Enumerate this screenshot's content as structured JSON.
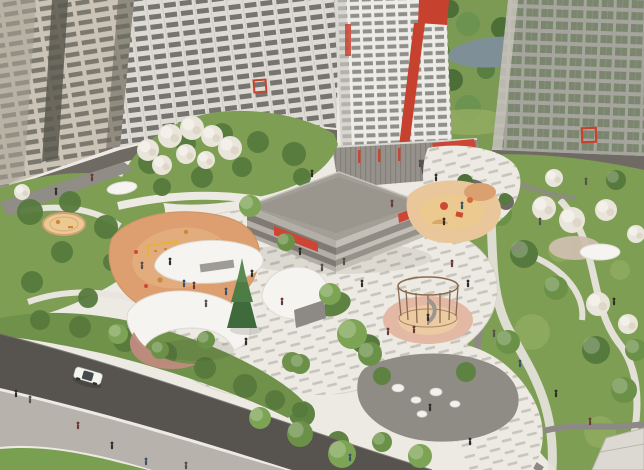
{
  "scene": {
    "kind": "Aerial architectural rendering of a residential courtyard with playgrounds, white canopy pavilions, winding paths, apartment towers and a road"
  },
  "palette": {
    "plaza": "#eceae3",
    "paver_dash": "#b0aca3",
    "lawn": "#7e9e54",
    "park_green": "#7c9a54",
    "pond": "#7e8f98",
    "road": "#57534e",
    "sidewalk": "#b7b3ac",
    "grass": "#79a050",
    "building_beige": "#cbc3b5",
    "building_white": "#dedbd4",
    "tower_white": "#edece8",
    "building_right": "#a6a59d",
    "plinth": "#6f6b64",
    "accent_red": "#c7412f",
    "awning_red": "#cd4534",
    "garage_roof": "#a39f97",
    "garage_face": "#b3afa7",
    "canopy_white": "#f5f4f0",
    "canopy_wall_pink": "#c08b80",
    "playground_orange": "#dd9f6f",
    "sand": "#ecc98e",
    "sand_pink": "#e3b8a4",
    "conifer": "#3e6a3c",
    "car_body": "#f4f4f1"
  },
  "scatter": {
    "person_colors": [
      "#2f2d2b",
      "#55504b",
      "#6b3a36",
      "#3a506b"
    ],
    "backdrop_trees": [
      [
        432,
        18,
        11
      ],
      [
        450,
        9,
        9
      ],
      [
        468,
        24,
        12
      ],
      [
        440,
        52,
        10
      ],
      [
        452,
        80,
        11
      ],
      [
        468,
        108,
        13
      ],
      [
        486,
        70,
        9
      ],
      [
        502,
        28,
        11
      ],
      [
        518,
        56,
        10
      ],
      [
        534,
        88,
        12
      ],
      [
        548,
        22,
        11
      ],
      [
        562,
        60,
        12
      ],
      [
        592,
        42,
        11
      ],
      [
        618,
        72,
        12
      ],
      [
        636,
        28,
        10
      ],
      [
        606,
        112,
        11
      ],
      [
        578,
        120,
        9
      ],
      [
        500,
        120,
        10
      ]
    ],
    "garden_bushes": [
      [
        150,
        162,
        12
      ],
      [
        186,
        144,
        10
      ],
      [
        222,
        134,
        11
      ],
      [
        258,
        142,
        11
      ],
      [
        294,
        154,
        12
      ],
      [
        242,
        167,
        10
      ],
      [
        202,
        177,
        11
      ],
      [
        162,
        187,
        9
      ],
      [
        302,
        177,
        9
      ],
      [
        30,
        212,
        13
      ],
      [
        70,
        202,
        11
      ],
      [
        106,
        227,
        12
      ],
      [
        62,
        252,
        11
      ],
      [
        112,
        262,
        9
      ],
      [
        32,
        282,
        11
      ],
      [
        88,
        298,
        10
      ],
      [
        134,
        252,
        9
      ],
      [
        140,
        276,
        10
      ]
    ],
    "garden_blossoms": [
      [
        148,
        150,
        1.1
      ],
      [
        170,
        136,
        1.2
      ],
      [
        192,
        128,
        1.2
      ],
      [
        212,
        136,
        1.1
      ],
      [
        230,
        148,
        1.2
      ],
      [
        186,
        154,
        1.0
      ],
      [
        162,
        165,
        1.0
      ],
      [
        206,
        160,
        0.9
      ],
      [
        22,
        192,
        0.8
      ]
    ],
    "park_trees": [
      [
        500,
        214,
        1.2
      ],
      [
        524,
        254,
        1.4
      ],
      [
        556,
        288,
        1.2
      ],
      [
        596,
        350,
        1.4
      ],
      [
        624,
        390,
        1.3
      ],
      [
        480,
        302,
        1.1
      ],
      [
        508,
        342,
        1.2
      ],
      [
        470,
        380,
        1.0
      ],
      [
        636,
        350,
        1.1
      ],
      [
        616,
        180,
        1.0
      ],
      [
        486,
        168,
        0.9
      ]
    ],
    "park_blossoms": [
      [
        544,
        208,
        1.2
      ],
      [
        572,
        220,
        1.3
      ],
      [
        606,
        210,
        1.1
      ],
      [
        598,
        304,
        1.2
      ],
      [
        628,
        324,
        1.0
      ],
      [
        636,
        234,
        0.9
      ],
      [
        554,
        178,
        0.9
      ]
    ],
    "meadow_patches": [
      [
        532,
        332,
        18
      ],
      [
        600,
        432,
        16
      ],
      [
        478,
        368,
        13
      ],
      [
        560,
        250,
        12
      ],
      [
        620,
        270,
        10
      ],
      [
        505,
        390,
        11
      ]
    ],
    "plaza_trees": [
      [
        352,
        334,
        1.5
      ],
      [
        370,
        354,
        1.2
      ],
      [
        330,
        294,
        1.1
      ],
      [
        300,
        364,
        1.0
      ],
      [
        260,
        418,
        1.1
      ],
      [
        300,
        434,
        1.3
      ],
      [
        342,
        454,
        1.4
      ],
      [
        206,
        340,
        0.9
      ],
      [
        118,
        334,
        1.0
      ],
      [
        160,
        350,
        0.9
      ],
      [
        420,
        456,
        1.2
      ],
      [
        382,
        442,
        1.0
      ],
      [
        250,
        206,
        1.1
      ],
      [
        286,
        242,
        0.9
      ]
    ],
    "hedge_shrubs": [
      [
        40,
        320,
        10
      ],
      [
        80,
        327,
        11
      ],
      [
        125,
        340,
        12
      ],
      [
        165,
        354,
        12
      ],
      [
        205,
        368,
        11
      ],
      [
        245,
        386,
        12
      ],
      [
        275,
        400,
        10
      ],
      [
        300,
        410,
        8
      ]
    ],
    "boulders": [
      [
        398,
        388,
        6
      ],
      [
        416,
        400,
        5
      ],
      [
        436,
        392,
        6
      ],
      [
        455,
        404,
        5
      ],
      [
        422,
        414,
        5
      ]
    ],
    "people_plaza": [
      [
        300,
        252,
        0
      ],
      [
        322,
        268,
        1
      ],
      [
        282,
        302,
        2
      ],
      [
        252,
        274,
        0
      ],
      [
        226,
        292,
        3
      ],
      [
        344,
        262,
        1
      ],
      [
        362,
        284,
        0
      ],
      [
        452,
        264,
        2
      ],
      [
        468,
        284,
        0
      ],
      [
        494,
        334,
        1
      ],
      [
        520,
        364,
        3
      ],
      [
        556,
        394,
        0
      ],
      [
        420,
        164,
        1
      ],
      [
        436,
        178,
        0
      ],
      [
        392,
        204,
        2
      ],
      [
        312,
        174,
        0
      ],
      [
        206,
        304,
        1
      ],
      [
        184,
        284,
        3
      ],
      [
        246,
        342,
        0
      ],
      [
        590,
        422,
        2
      ],
      [
        614,
        302,
        0
      ],
      [
        540,
        222,
        1
      ],
      [
        470,
        442,
        0
      ],
      [
        350,
        458,
        3
      ],
      [
        586,
        182,
        1
      ],
      [
        388,
        332,
        2
      ],
      [
        430,
        408,
        0
      ]
    ],
    "people_walkways": [
      [
        16,
        394,
        0
      ],
      [
        30,
        400,
        1
      ],
      [
        78,
        426,
        2
      ],
      [
        112,
        446,
        0
      ],
      [
        146,
        462,
        3
      ],
      [
        186,
        466,
        1
      ],
      [
        56,
        192,
        0
      ],
      [
        92,
        178,
        2
      ]
    ],
    "people_playground": [
      [
        170,
        262,
        0
      ],
      [
        194,
        286,
        2
      ],
      [
        142,
        266,
        1
      ],
      [
        444,
        222,
        0
      ],
      [
        462,
        206,
        3
      ],
      [
        428,
        318,
        0
      ],
      [
        414,
        330,
        2
      ]
    ]
  }
}
